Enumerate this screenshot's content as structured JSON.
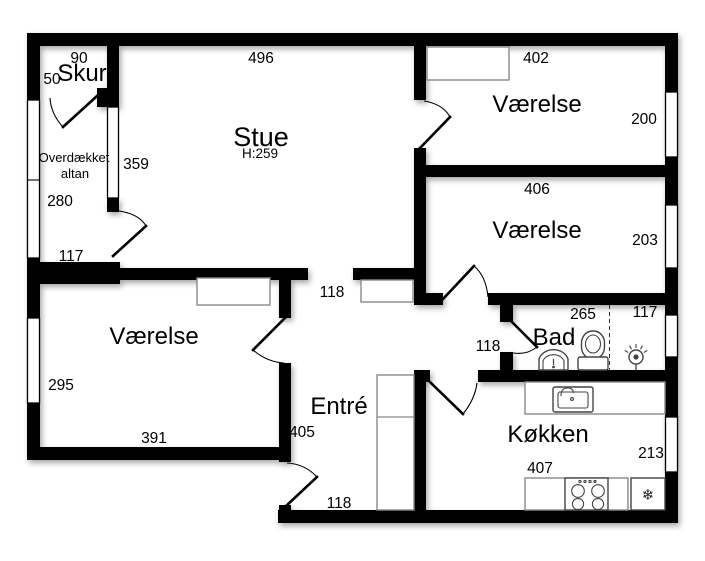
{
  "rooms": {
    "skur": {
      "name": "Skur"
    },
    "stue": {
      "name": "Stue",
      "ceiling_height": "H:259"
    },
    "vaerelse_ne": {
      "name": "Værelse"
    },
    "vaerelse_e": {
      "name": "Værelse"
    },
    "vaerelse_sw": {
      "name": "Værelse"
    },
    "altan": {
      "name_line1": "Overdækket",
      "name_line2": "altan"
    },
    "entre": {
      "name": "Entré"
    },
    "bad": {
      "name": "Bad"
    },
    "koekken": {
      "name": "Køkken"
    }
  },
  "dimensions_cm": {
    "skur_width": "90",
    "skur_depth": "50",
    "stue_width": "496",
    "stue_depth": "359",
    "vaerelse_ne_width": "402",
    "vaerelse_ne_depth": "200",
    "vaerelse_e_width": "406",
    "vaerelse_e_depth": "203",
    "altan_depth": "280",
    "altan_width": "117",
    "hall_upper_width": "118",
    "bad_width": "265",
    "bad_shower_width": "117",
    "hall_bad_width": "118",
    "vaerelse_sw_depth": "295",
    "vaerelse_sw_width": "391",
    "entre_length": "405",
    "koekken_width": "407",
    "koekken_depth": "213",
    "entre_hall_width": "118"
  },
  "icons": {
    "fridge_snowflake": "❄"
  },
  "colors": {
    "wall": "#000000",
    "floor": "#ffffff",
    "fixture_outline": "#444444"
  }
}
